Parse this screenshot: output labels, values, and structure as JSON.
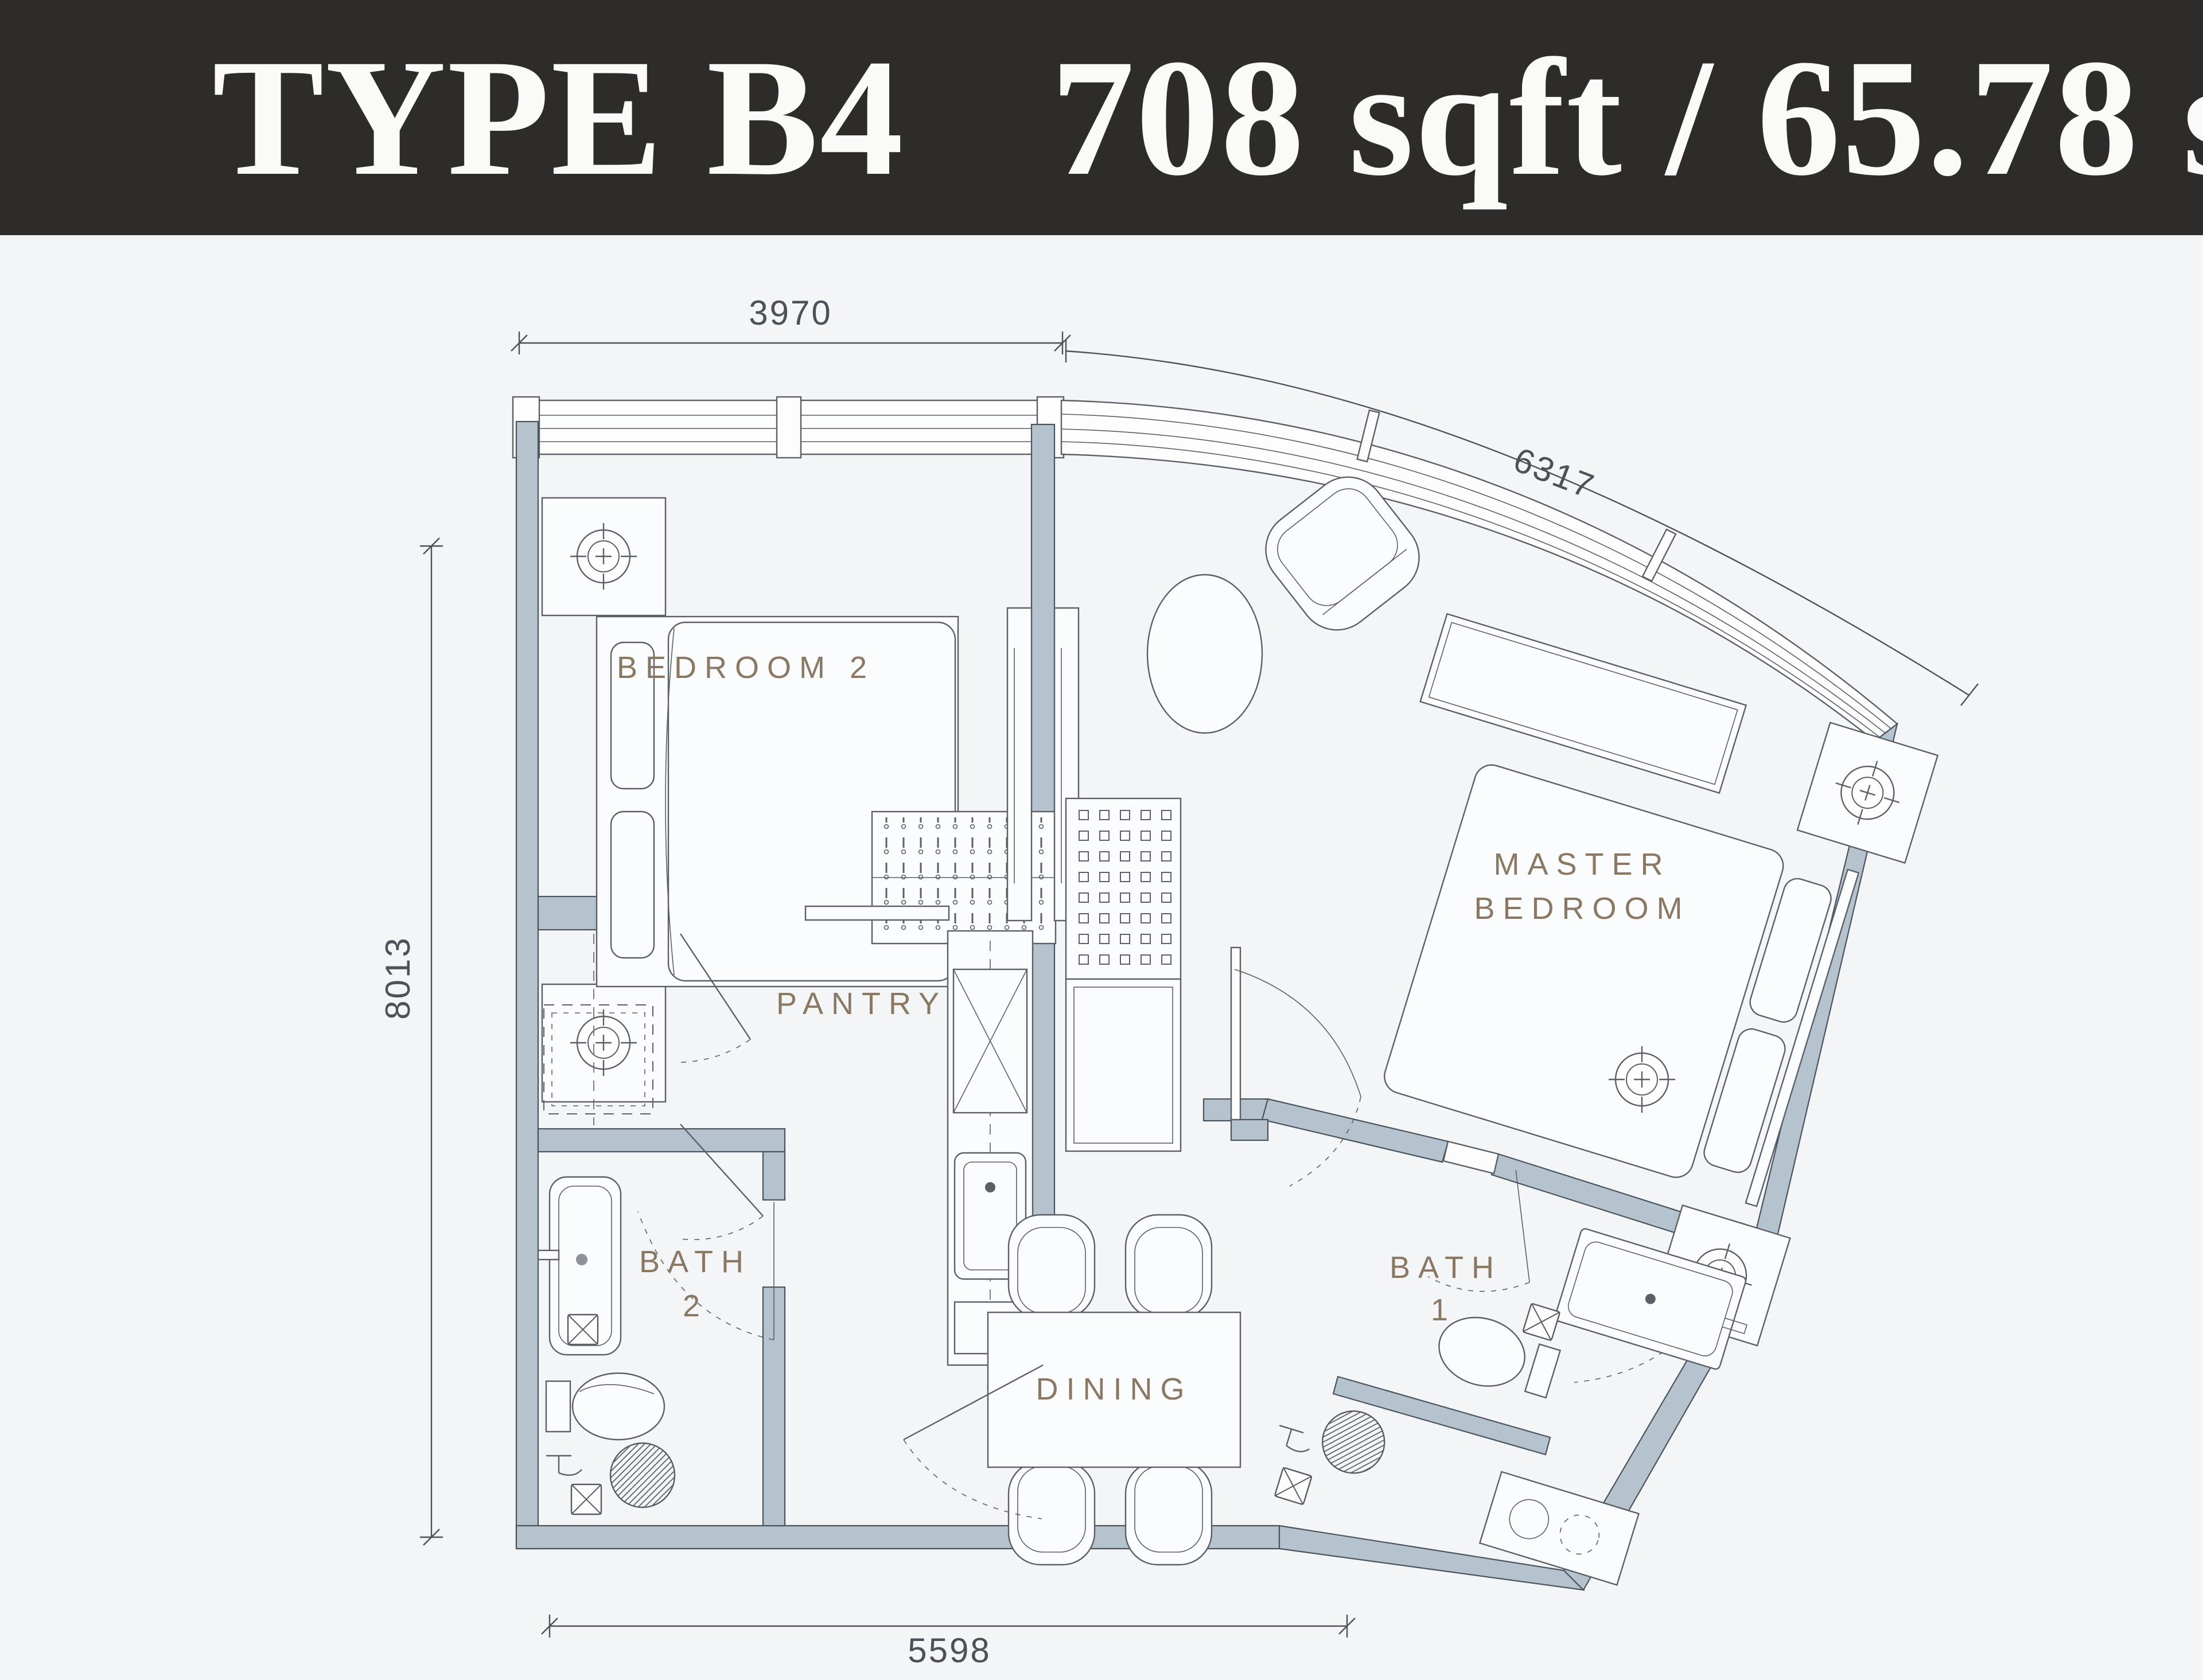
{
  "header": {
    "title": "TYPE B4",
    "area": "708 sqft / 65.78 sqm"
  },
  "dimensions": {
    "top": "3970",
    "facade_curve": "6317",
    "left": "8013",
    "bottom": "5598"
  },
  "rooms": {
    "bedroom2": "BEDROOM 2",
    "pantry": "PANTRY",
    "bath2_line1": "BATH",
    "bath2_line2": "2",
    "dining": "DINING",
    "bath1_line1": "BATH",
    "bath1_line2": "1",
    "master_line1": "MASTER",
    "master_line2": "BEDROOM"
  },
  "colors": {
    "header_bg": "#2d2c2b",
    "header_fg": "#fafaf8",
    "canvas_bg": "#f4f5f6",
    "wall_fill": "#b5c3ce",
    "wall_stroke": "#4a545e",
    "line": "#5a6065",
    "label": "#8b7862",
    "dim": "#4c5257"
  }
}
